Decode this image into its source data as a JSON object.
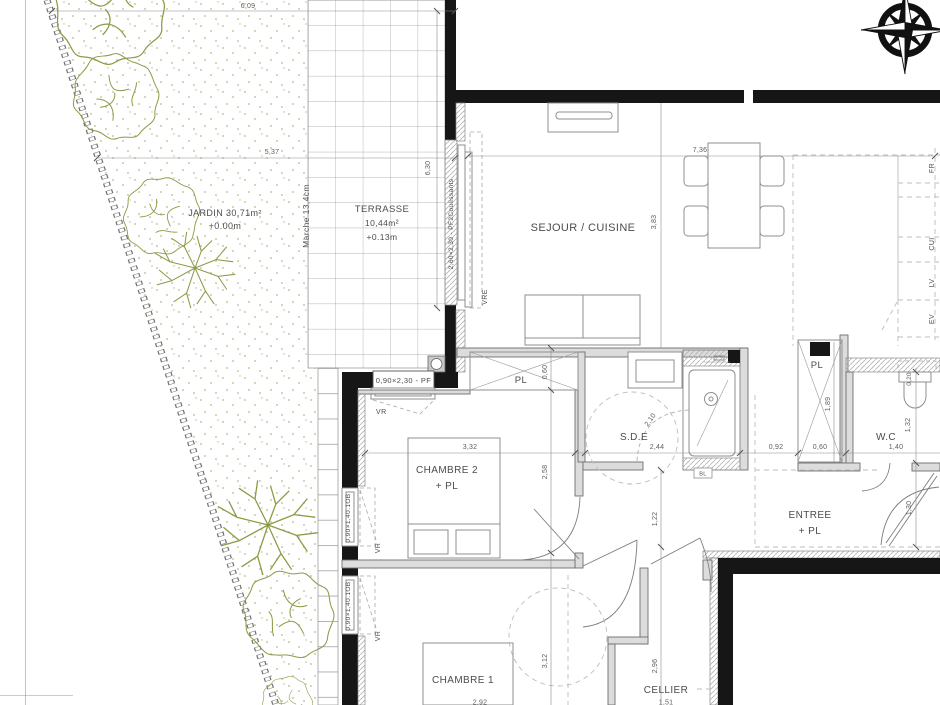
{
  "title": "Floor plan – apartment with garden",
  "colors": {
    "ink": "#4c4c4c",
    "dim": "#5d5d5d",
    "wall": "#161616",
    "green": "#8d9b45",
    "tan": "#bfb68e"
  },
  "labels": {
    "jardin1": "JARDIN 30,71m²",
    "jardin2": "+0.00m",
    "marche": "Marche 13,4cm",
    "terrasse1": "TERRASSE",
    "terrasse2": "10,44m²",
    "terrasse3": "+0.13m",
    "sejour": "SEJOUR / CUISINE",
    "chambre2a": "CHAMBRE 2",
    "chambre2b": "+ PL",
    "chambre1": "CHAMBRE 1",
    "sde": "S.D.E",
    "wc": "W.C",
    "entree1": "ENTREE",
    "entree2": "+ PL",
    "cellier": "CELLIER",
    "pl_left": "PL",
    "pl_right": "PL",
    "bl": "BL"
  },
  "windows": {
    "sliding": "2,60×2,30 - PF2Coulissants",
    "pf": "0,90×2,30 - PF",
    "ob1": "0,90×1,40.1OB",
    "ob2": "0,90×1,40.1OB",
    "vr1": "VR",
    "vr2": "VR",
    "vr3": "VR",
    "vre": "VRE"
  },
  "appliances": {
    "fr": "FR",
    "cui": "CUI",
    "lv": "LV",
    "ev": "EV"
  },
  "dims": {
    "d609": "6,09",
    "d537": "5,37",
    "d630": "6,30",
    "d736": "7,36",
    "d383": "3,83",
    "d332": "3,32",
    "d258": "2,58",
    "d060a": "0,60",
    "d244": "2,44",
    "d210": "2,10",
    "d122": "1,22",
    "d092": "0,92",
    "d060b": "0,60",
    "d140": "1,40",
    "d189": "1,89",
    "d132": "1,32",
    "d020": "0,20",
    "d130": "1,30",
    "d312": "3,12",
    "d296": "2,96",
    "d292": "2,92",
    "d151": "1,51"
  }
}
